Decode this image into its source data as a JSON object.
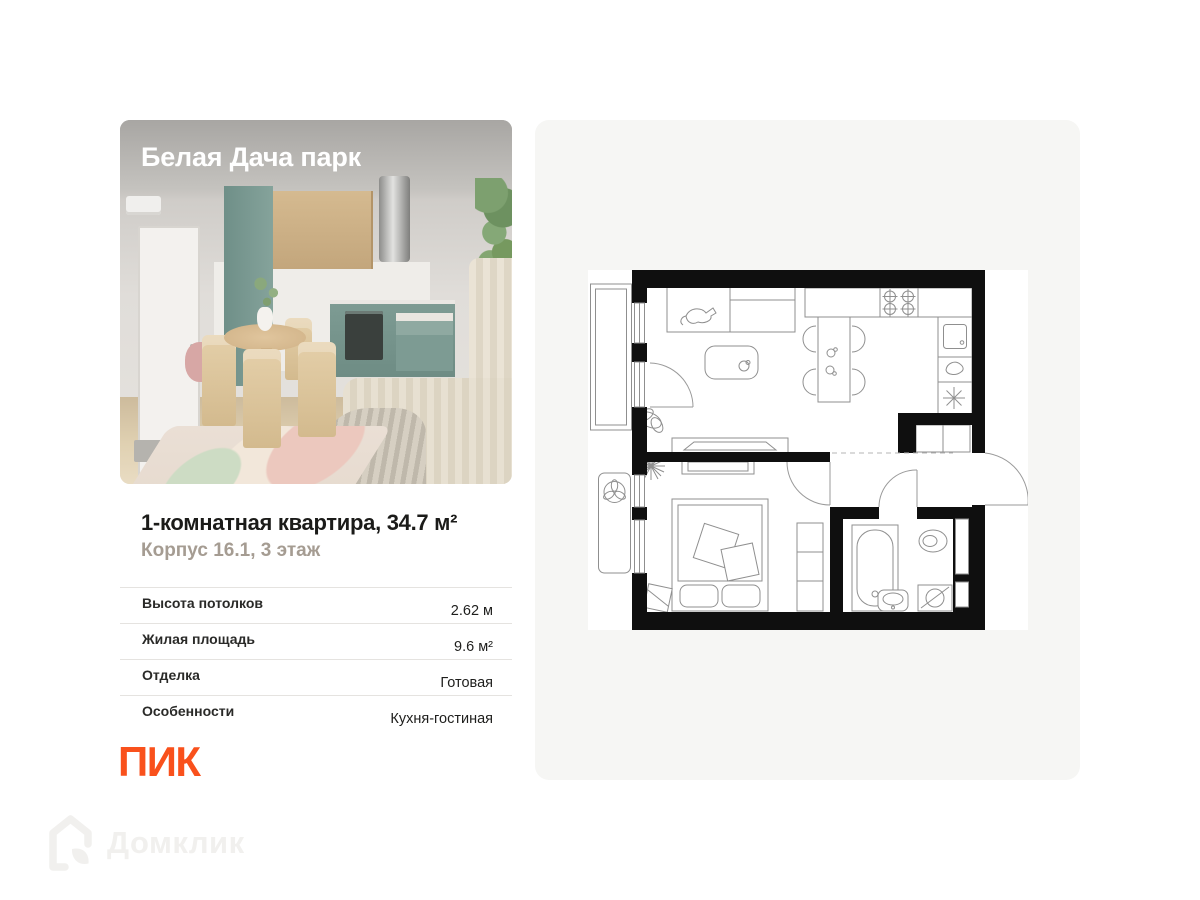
{
  "card": {
    "photo_label": "Белая Дача парк",
    "title": "1-комнатная квартира, 34.7 м²",
    "subtitle": "Корпус 16.1, 3 этаж"
  },
  "specs": {
    "rows": [
      {
        "label": "Высота потолков",
        "value": "2.62 м"
      },
      {
        "label": "Жилая площадь",
        "value": "9.6 м²"
      },
      {
        "label": "Отделка",
        "value": "Готовая"
      },
      {
        "label": "Особенности",
        "value": "Кухня-гостиная"
      }
    ]
  },
  "branding": {
    "developer": "ПИК",
    "watermark": "Домклик"
  },
  "colors": {
    "developer_orange": "#f9511c",
    "watermark_gray": "#f1f0ee",
    "panel_background": "#f6f6f4",
    "plan_walls": "#0f0f0f"
  },
  "floorplan": {
    "features": [
      "balcony",
      "window",
      "balcony-door",
      "sofa",
      "cat",
      "coffee-table",
      "dining-table",
      "chairs",
      "stove",
      "kitchen-sink",
      "kettle",
      "fridge",
      "hall-closet",
      "entrance-door",
      "bedroom-door",
      "tv",
      "bed",
      "nightstand",
      "wardrobe",
      "plants",
      "bathtub",
      "toilet",
      "bathroom-sink",
      "washing-machine",
      "air-conditioner"
    ]
  }
}
